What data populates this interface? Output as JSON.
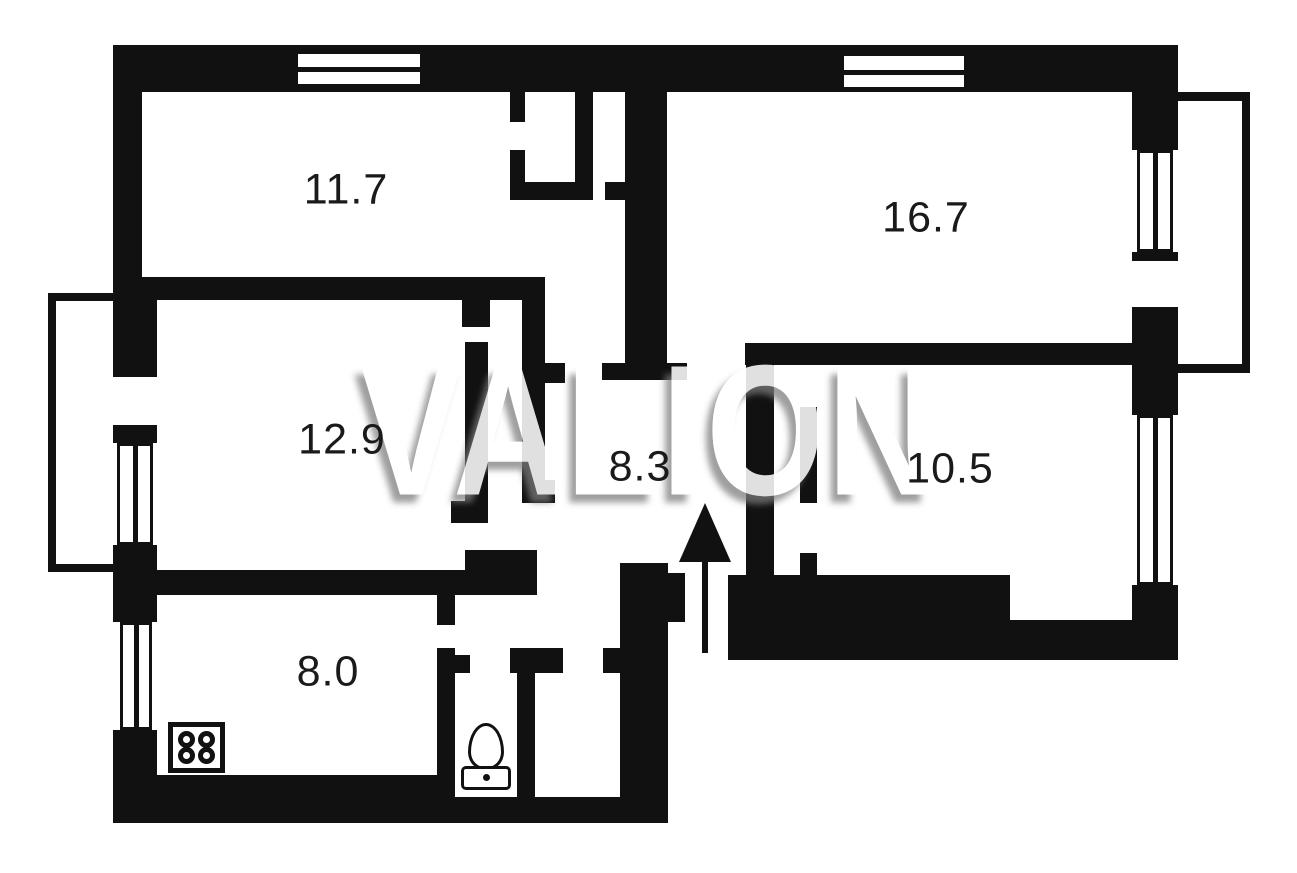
{
  "watermark": {
    "text": "VALION",
    "fill_color": "#ffffff",
    "shadow_color": "#7d7d7d"
  },
  "rooms": [
    {
      "name": "room-top-left",
      "area_label": "11.7"
    },
    {
      "name": "room-top-right",
      "area_label": "16.7"
    },
    {
      "name": "room-middle-left",
      "area_label": "12.9"
    },
    {
      "name": "hallway-center",
      "area_label": "8.3"
    },
    {
      "name": "room-middle-right",
      "area_label": "10.5"
    },
    {
      "name": "kitchen-bottom-left",
      "area_label": "8.0"
    }
  ],
  "icons": {
    "stove": "stove-4-burner-icon",
    "toilet": "toilet-icon",
    "entrance": "arrow-up-entrance-icon",
    "windows": [
      "window-top-left",
      "window-top-right",
      "window-left-middle",
      "window-left-kitchen",
      "window-right-upper",
      "window-right-lower"
    ],
    "balconies": [
      "balcony-left",
      "balcony-right"
    ]
  },
  "colors": {
    "wall": "#111111",
    "background": "#ffffff"
  }
}
